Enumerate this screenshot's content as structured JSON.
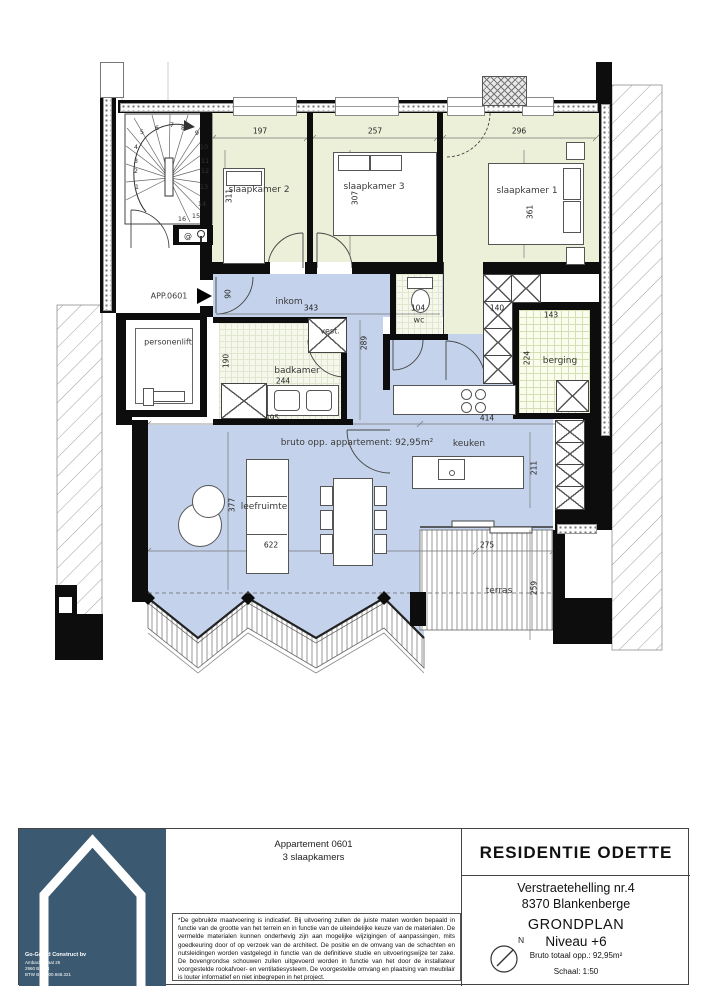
{
  "plan": {
    "app_label": "APP.0601",
    "area_note": "bruto opp. appartement: 92,95m²",
    "intercom_symbol": "@",
    "stair_steps": [
      "1",
      "2",
      "3",
      "4",
      "5",
      "6",
      "7",
      "8",
      "9",
      "10",
      "11",
      "12",
      "13",
      "14",
      "15",
      "16"
    ],
    "rooms": {
      "slaapkamer2": {
        "label": "slaapkamer 2",
        "width": "197",
        "height": "311"
      },
      "slaapkamer3": {
        "label": "slaapkamer 3",
        "width": "257",
        "height": "307"
      },
      "slaapkamer1": {
        "label": "slaapkamer 1",
        "width": "296",
        "height": "361"
      },
      "inkom": {
        "label": "inkom",
        "width": "343",
        "height": "90"
      },
      "vestiaire": {
        "label": "vest."
      },
      "badkamer": {
        "label": "badkamer",
        "width": "244",
        "height": "190"
      },
      "wc": {
        "label": "wc",
        "width": "104"
      },
      "berging": {
        "label": "berging",
        "width": "143",
        "height": "224"
      },
      "personenlift": {
        "label": "personenlift"
      },
      "keuken": {
        "label": "keuken",
        "width": "414",
        "height": "211"
      },
      "leefruimte": {
        "label": "leefruimte",
        "width": "622",
        "height": "377"
      },
      "terras": {
        "label": "terras",
        "width": "275",
        "height": "259"
      }
    },
    "dims": {
      "strook": "495",
      "kast": "140",
      "gang": "289"
    },
    "colors": {
      "bedroom_fill": "#edf0d9",
      "circulation_fill": "#c4d3eb",
      "wall": "#0d0d0d"
    }
  },
  "titleblock": {
    "apartment": "Appartement 0601",
    "apartment_sub": "3 slaapkamers",
    "project": "RESIDENTIE ODETTE",
    "address1": "Verstraetehelling nr.4",
    "address2": "8370 Blankenberge",
    "plan_type": "GRONDPLAN",
    "level": "Niveau +6",
    "gross_area": "Bruto totaal opp.: 92,95m²",
    "scale": "Schaal: 1:50",
    "north": "N",
    "disclaimer": "*De gebruikte maatvoering is indicatief. Bij uitvoering zullen de juiste maten worden bepaald in functie van de grootte van het terrein en in functie van de uiteindelijke keuze van de materialen. De vermelde materialen kunnen onderhevig zijn aan mogelijke wijzigingen of aanpassingen, mits goedkeuring door of op verzoek van de architect. De positie en de omvang van de schachten en nutsleidingen worden vastgelegd in functie van de definitieve studie en uitvoeringswijze ter zake. De bovengrondse schouwen zullen uitgevoerd worden in functie van het door de installateur voorgestelde rookafvoer- en ventilatiesysteem. De voorgestelde omvang en plaatsing van meubilair is louter informatief en niet inbegrepen in het project.",
    "company": {
      "name": "Go-Grand Construct bv",
      "street": "Ambachtstraat 25",
      "city": "2960 Brecht",
      "vat": "BTW BE 1000.668.321"
    },
    "logo_color": "#3b5970"
  }
}
